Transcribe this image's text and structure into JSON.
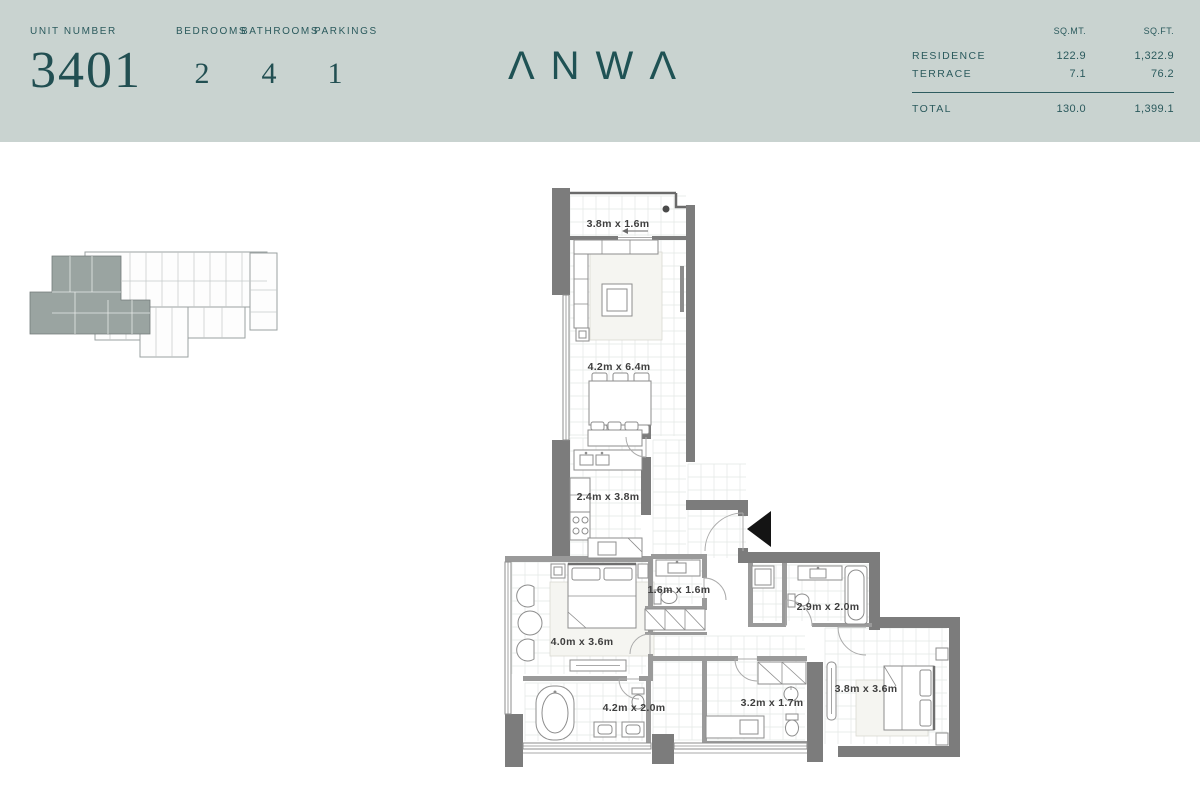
{
  "header": {
    "unit_number_label": "UNIT NUMBER",
    "unit_number": "3401",
    "stats": [
      {
        "label": "BEDROOMS",
        "value": "2"
      },
      {
        "label": "BATHROOMS",
        "value": "4"
      },
      {
        "label": "PARKINGS",
        "value": "1"
      }
    ],
    "logo_text": "ΛNWΛ",
    "area_table": {
      "col_headers": [
        "SQ.MT.",
        "SQ.FT."
      ],
      "rows": [
        {
          "label": "RESIDENCE",
          "sqmt": "122.9",
          "sqft": "1,322.9"
        },
        {
          "label": "TERRACE",
          "sqmt": "7.1",
          "sqft": "76.2"
        }
      ],
      "total": {
        "label": "TOTAL",
        "sqmt": "130.0",
        "sqft": "1,399.1"
      }
    }
  },
  "floor_plan": {
    "rooms": [
      {
        "name": "terrace",
        "dimensions": "3.8m x 1.6m"
      },
      {
        "name": "living-dining",
        "dimensions": "4.2m x 6.4m"
      },
      {
        "name": "kitchen",
        "dimensions": "2.4m x 3.8m"
      },
      {
        "name": "powder-room",
        "dimensions": "1.6m x 1.6m"
      },
      {
        "name": "bathroom-2",
        "dimensions": "2.9m x 2.0m"
      },
      {
        "name": "master-bedroom",
        "dimensions": "4.0m x 3.6m"
      },
      {
        "name": "master-bathroom",
        "dimensions": "4.2m x 2.0m"
      },
      {
        "name": "bathroom-3",
        "dimensions": "3.2m x 1.7m"
      },
      {
        "name": "bedroom-2",
        "dimensions": "3.8m x 3.6m"
      }
    ]
  },
  "colors": {
    "header_bg": "#c9d3d0",
    "brand_teal": "#255659",
    "wall_gray": "#7c7c7c",
    "plan_line": "#8d8d8d",
    "highlight_unit": "#9aa4a1"
  }
}
